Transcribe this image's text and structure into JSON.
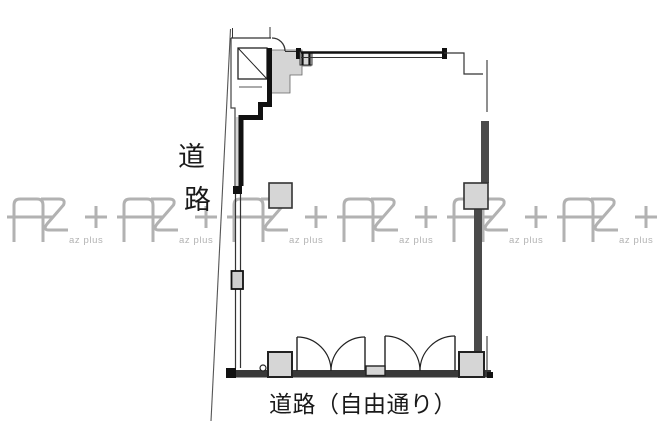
{
  "plan": {
    "road_label_vertical": {
      "char1": "道",
      "char2": "路"
    },
    "bottom_road_label": "道路（自由通り）"
  },
  "watermark": {
    "label": "az plus",
    "color": "#b2b2b2"
  },
  "colors": {
    "background": "#ffffff",
    "wall_black": "#1a1a1a",
    "wall_dark_gray": "#4a4a4a",
    "fill_light_gray": "#d5d5d5",
    "watermark_gray": "#b2b2b2"
  }
}
